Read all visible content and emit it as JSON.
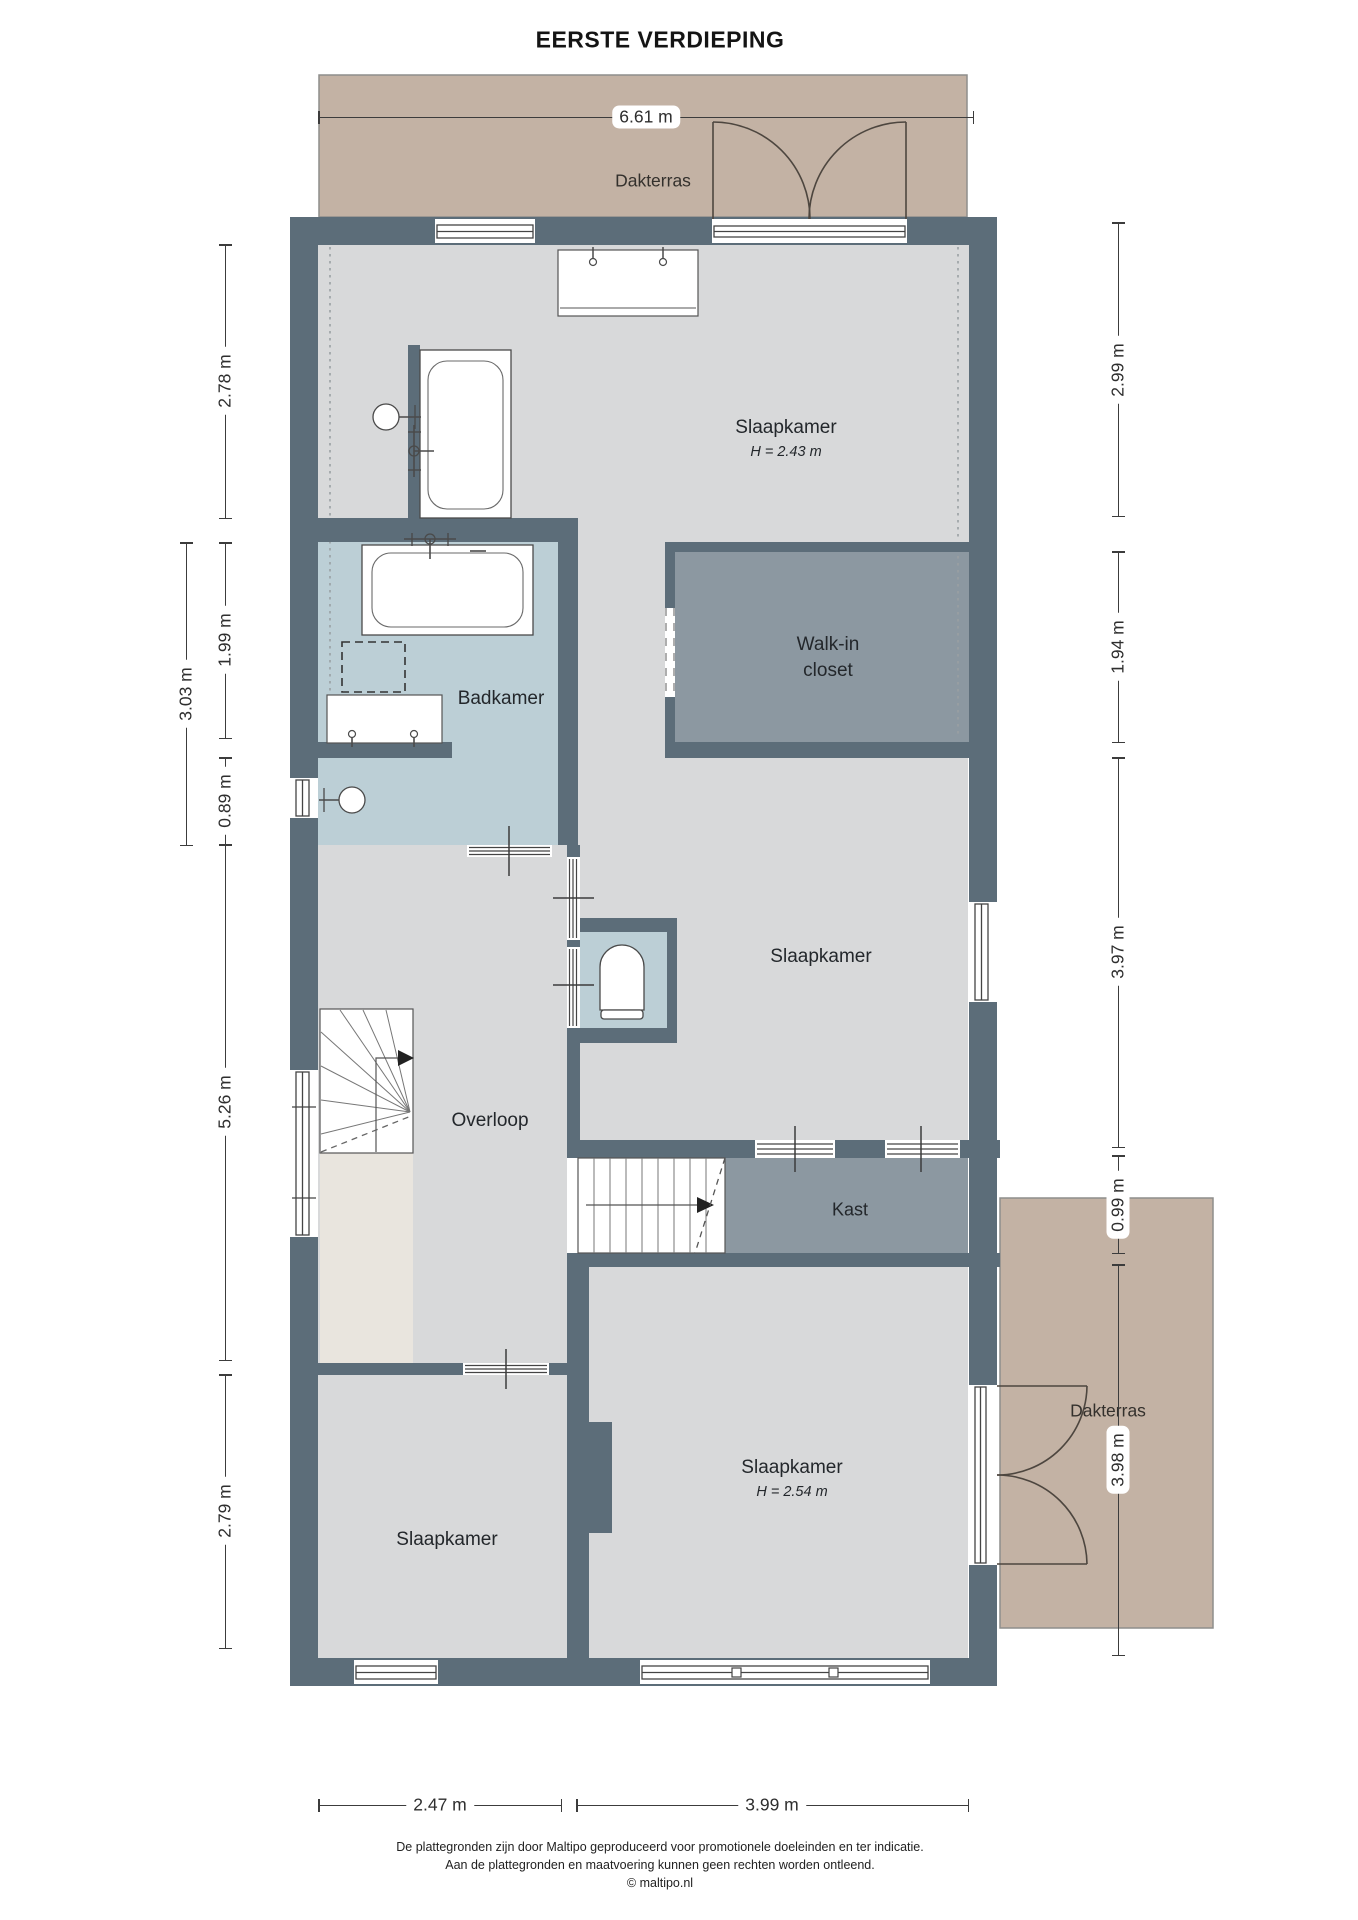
{
  "title": "EERSTE VERDIEPING",
  "rooms": {
    "dakterras_top": "Dakterras",
    "dakterras_bottom": "Dakterras",
    "slaapkamer_top": "Slaapkamer",
    "slaapkamer_top_height": "H = 2.43 m",
    "badkamer": "Badkamer",
    "walkin_line1": "Walk-in",
    "walkin_line2": "closet",
    "slaapkamer_mid": "Slaapkamer",
    "overloop": "Overloop",
    "kast": "Kast",
    "slaapkamer_bottom_left": "Slaapkamer",
    "slaapkamer_bottom_right": "Slaapkamer",
    "slaapkamer_bottom_right_height": "H = 2.54 m"
  },
  "dimensions": {
    "top_width": "6.61 m",
    "left_278": "2.78 m",
    "left_303": "3.03 m",
    "left_199": "1.99 m",
    "left_089": "0.89 m",
    "left_526": "5.26 m",
    "left_279": "2.79 m",
    "right_299": "2.99 m",
    "right_194": "1.94 m",
    "right_397": "3.97 m",
    "right_099": "0.99 m",
    "right_398": "3.98 m",
    "bottom_247": "2.47 m",
    "bottom_399": "3.99 m"
  },
  "footer": {
    "line1": "De plattegronden zijn door Maltipo geproduceerd voor promotionele doeleinden en ter indicatie.",
    "line2": "Aan de plattegronden en maatvoering kunnen geen rechten worden ontleend.",
    "line3": "© maltipo.nl"
  },
  "colors": {
    "wall": "#5c6d79",
    "floor": "#d8d9da",
    "wet_room": "#bccfd6",
    "closet": "#8c98a1",
    "terrace": "#c3b2a4",
    "void": "#e9e5de",
    "fixture_line": "#4a4a4a",
    "dimension_line": "#3c3c3c",
    "text": "#23272b"
  }
}
